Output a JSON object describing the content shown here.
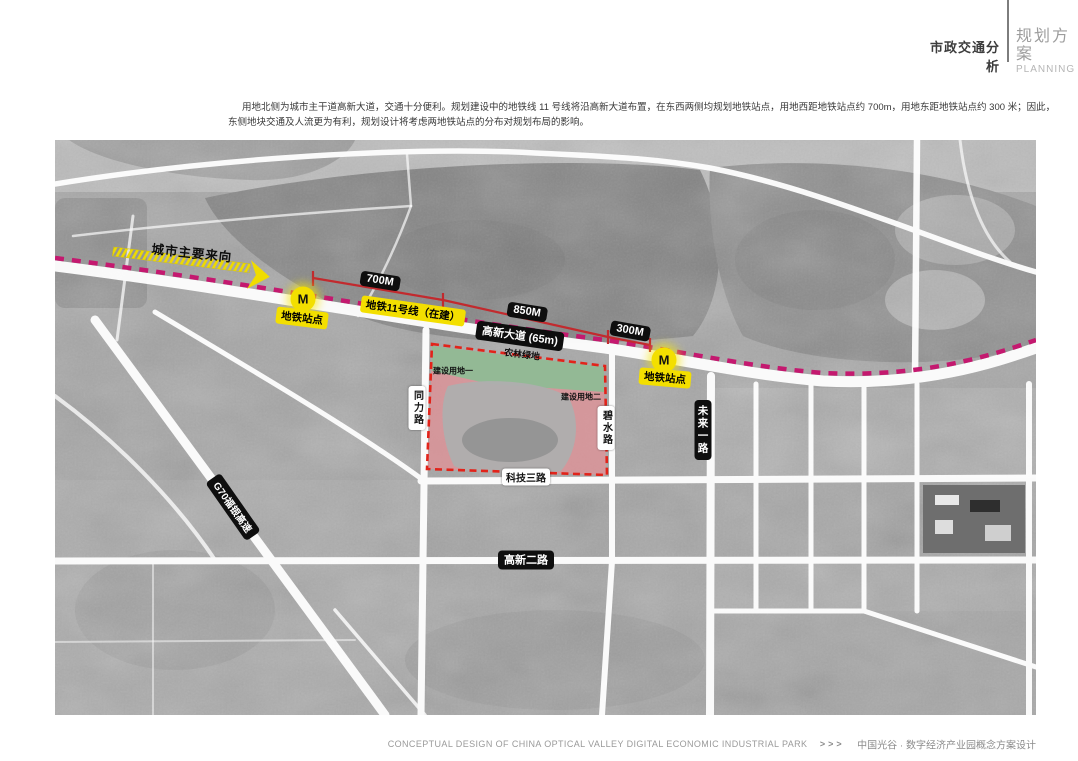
{
  "header": {
    "section_title": "市政交通分析",
    "subtitle_cn": "规划方案",
    "subtitle_en": "PLANNING"
  },
  "intro": {
    "line1": "用地北侧为城市主干道高新大道，交通十分便利。规划建设中的地铁线 11 号线将沿高新大道布置，在东西两侧均规划地铁站点，用地西距地铁站点约 700m，用地东距地铁站点约 300 米；因此，",
    "line2": "东侧地块交通及人流更为有利，规划设计将考虑两地铁站点的分布对规划布局的影响。"
  },
  "map": {
    "direction_arrow_label": "城市主要来向",
    "metro_line_label": "地铁11号线（在建）",
    "avenue_label": "高新大道 (65m)",
    "distances": [
      {
        "label": "700M"
      },
      {
        "label": "850M"
      },
      {
        "label": "300M"
      }
    ],
    "stations": [
      {
        "marker": "M",
        "label": "地铁站点"
      },
      {
        "marker": "M",
        "label": "地铁站点"
      }
    ],
    "site": {
      "green_label": "农林绿地",
      "parcel1": "建设用地一",
      "parcel2": "建设用地二"
    },
    "roads": {
      "tongli": "同力路",
      "bishui": "碧水路",
      "keji3": "科技三路",
      "weilai1": "未来一路",
      "gaoxin2": "高新二路",
      "g70": "G70福银高速"
    },
    "colors": {
      "metro_dash": "#c4196f",
      "site_boundary": "#e2231a",
      "parcel_pink": "#e09297",
      "green_buffer": "#8cbd95",
      "highlight_yellow": "#f3df00",
      "measure_red": "#c22a2e"
    }
  },
  "footer": {
    "english": "CONCEPTUAL DESIGN OF CHINA OPTICAL VALLEY DIGITAL ECONOMIC INDUSTRIAL PARK",
    "arrows": ">>>",
    "chinese": "中国光谷 · 数字经济产业园概念方案设计"
  }
}
